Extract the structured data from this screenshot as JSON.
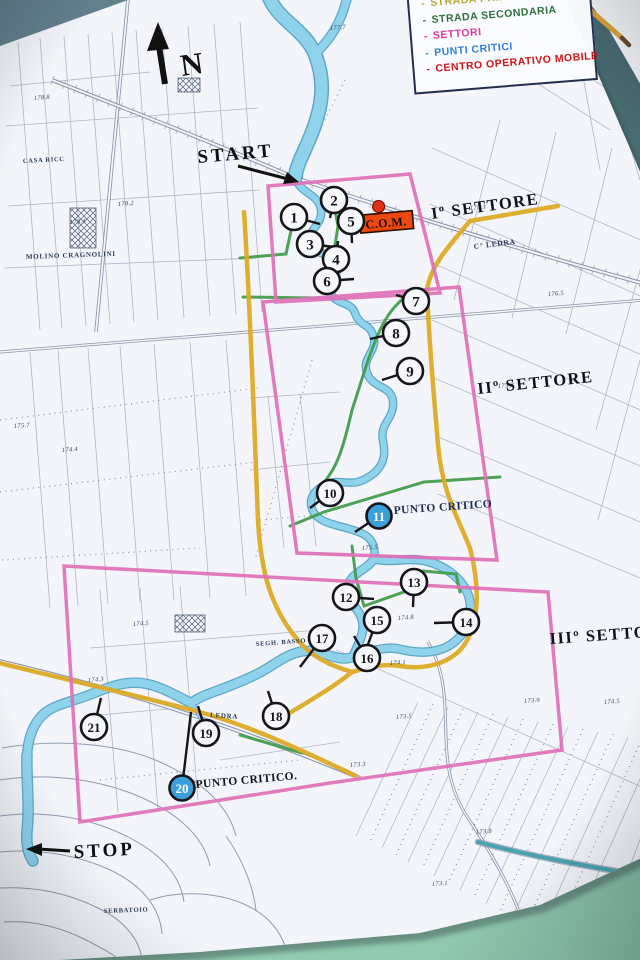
{
  "legend": {
    "items": [
      {
        "label": "STRADA PRINCIPALE",
        "color": "#b4a832"
      },
      {
        "label": "STRADA SECONDARIA",
        "color": "#2e6f3e"
      },
      {
        "label": "SETTORI",
        "color": "#e0379d"
      },
      {
        "label": "PUNTI CRITICI",
        "color": "#2f7fd8"
      },
      {
        "label": "CENTRO OPERATIVO MOBILE",
        "color": "#d01515"
      }
    ]
  },
  "compass": {
    "north_label": "N"
  },
  "route": {
    "start_label": "START",
    "stop_label": "STOP"
  },
  "sectors": [
    {
      "label": "Iº SETTORE"
    },
    {
      "label": "IIº SETTORE"
    },
    {
      "label": "IIIº SETTORE"
    }
  ],
  "com": {
    "label": "C.O.M."
  },
  "critical_points": [
    {
      "label": "PUNTO CRITICO"
    },
    {
      "label": "PUNTO CRITICO."
    }
  ],
  "stations": [
    {
      "n": "1",
      "x": 294,
      "y": 217,
      "lx": 320,
      "ly": 224,
      "critical": false
    },
    {
      "n": "2",
      "x": 334,
      "y": 200,
      "lx": 330,
      "ly": 218,
      "critical": false
    },
    {
      "n": "3",
      "x": 310,
      "y": 244,
      "lx": 334,
      "ly": 247,
      "critical": false
    },
    {
      "n": "4",
      "x": 336,
      "y": 259,
      "lx": 338,
      "ly": 241,
      "critical": false
    },
    {
      "n": "5",
      "x": 351,
      "y": 221,
      "lx": 352,
      "ly": 243,
      "critical": false
    },
    {
      "n": "6",
      "x": 327,
      "y": 281,
      "lx": 354,
      "ly": 279,
      "critical": false
    },
    {
      "n": "7",
      "x": 416,
      "y": 301,
      "lx": 396,
      "ly": 295,
      "critical": false
    },
    {
      "n": "8",
      "x": 396,
      "y": 333,
      "lx": 370,
      "ly": 339,
      "critical": false
    },
    {
      "n": "9",
      "x": 410,
      "y": 371,
      "lx": 382,
      "ly": 380,
      "critical": false
    },
    {
      "n": "10",
      "x": 330,
      "y": 493,
      "lx": 310,
      "ly": 508,
      "critical": false
    },
    {
      "n": "11",
      "x": 379,
      "y": 516,
      "lx": 355,
      "ly": 532,
      "critical": true
    },
    {
      "n": "12",
      "x": 346,
      "y": 597,
      "lx": 374,
      "ly": 599,
      "critical": false
    },
    {
      "n": "13",
      "x": 414,
      "y": 582,
      "lx": 413,
      "ly": 607,
      "critical": false
    },
    {
      "n": "14",
      "x": 466,
      "y": 622,
      "lx": 434,
      "ly": 623,
      "critical": false
    },
    {
      "n": "15",
      "x": 377,
      "y": 620,
      "lx": 367,
      "ly": 647,
      "critical": false
    },
    {
      "n": "16",
      "x": 367,
      "y": 658,
      "lx": 354,
      "ly": 636,
      "critical": false
    },
    {
      "n": "17",
      "x": 322,
      "y": 638,
      "lx": 300,
      "ly": 667,
      "critical": false
    },
    {
      "n": "18",
      "x": 276,
      "y": 716,
      "lx": 268,
      "ly": 691,
      "critical": false
    },
    {
      "n": "19",
      "x": 206,
      "y": 733,
      "lx": 198,
      "ly": 706,
      "critical": false
    },
    {
      "n": "20",
      "x": 182,
      "y": 788,
      "lx": 191,
      "ly": 712,
      "critical": true
    },
    {
      "n": "21",
      "x": 94,
      "y": 727,
      "lx": 101,
      "ly": 698,
      "critical": false
    }
  ],
  "map_labels": [
    {
      "text": "CASA RICC",
      "x": 23,
      "y": 163,
      "r": -3,
      "s": 6.5
    },
    {
      "text": "MOLINO CRAGNOLINI",
      "x": 26,
      "y": 259,
      "r": -2,
      "s": 7
    },
    {
      "text": "C° LEDRA",
      "x": 474,
      "y": 249,
      "r": -7,
      "s": 7.5
    },
    {
      "text": "SEGH. BASSO",
      "x": 256,
      "y": 646,
      "r": -4,
      "s": 6.5
    },
    {
      "text": "LEDRA",
      "x": 210,
      "y": 717,
      "r": 4,
      "s": 7
    },
    {
      "text": "SERBATOIO",
      "x": 104,
      "y": 913,
      "r": -2,
      "s": 6.5
    }
  ],
  "spot_heights": [
    {
      "v": "178.8",
      "x": 34,
      "y": 100
    },
    {
      "v": "178.2",
      "x": 118,
      "y": 206
    },
    {
      "v": "178.4",
      "x": 70,
      "y": 224
    },
    {
      "v": "177.7",
      "x": 330,
      "y": 30
    },
    {
      "v": "177.3",
      "x": 470,
      "y": 210
    },
    {
      "v": "176.5",
      "x": 548,
      "y": 296
    },
    {
      "v": "175.7",
      "x": 14,
      "y": 428
    },
    {
      "v": "175.3",
      "x": 498,
      "y": 388
    },
    {
      "v": "174.4",
      "x": 62,
      "y": 452
    },
    {
      "v": "174.5",
      "x": 133,
      "y": 626
    },
    {
      "v": "174.3",
      "x": 88,
      "y": 682
    },
    {
      "v": "174.1",
      "x": 390,
      "y": 665
    },
    {
      "v": "174.5",
      "x": 604,
      "y": 704
    },
    {
      "v": "173.9",
      "x": 524,
      "y": 703
    },
    {
      "v": "173.5",
      "x": 396,
      "y": 719
    },
    {
      "v": "173.3",
      "x": 350,
      "y": 767
    },
    {
      "v": "173.8",
      "x": 476,
      "y": 834
    },
    {
      "v": "173.1",
      "x": 432,
      "y": 886
    },
    {
      "v": "174.8",
      "x": 398,
      "y": 620
    },
    {
      "v": "175.5",
      "x": 362,
      "y": 550
    }
  ],
  "colors": {
    "main_road": "#dcab26",
    "secondary_road": "#3f9b48",
    "sector_border": "#e070b8",
    "critical_fill": "#39a0dc",
    "station_fill": "#f6f8fc",
    "river": "#8fd2ec",
    "com_box": "#ee4811"
  }
}
